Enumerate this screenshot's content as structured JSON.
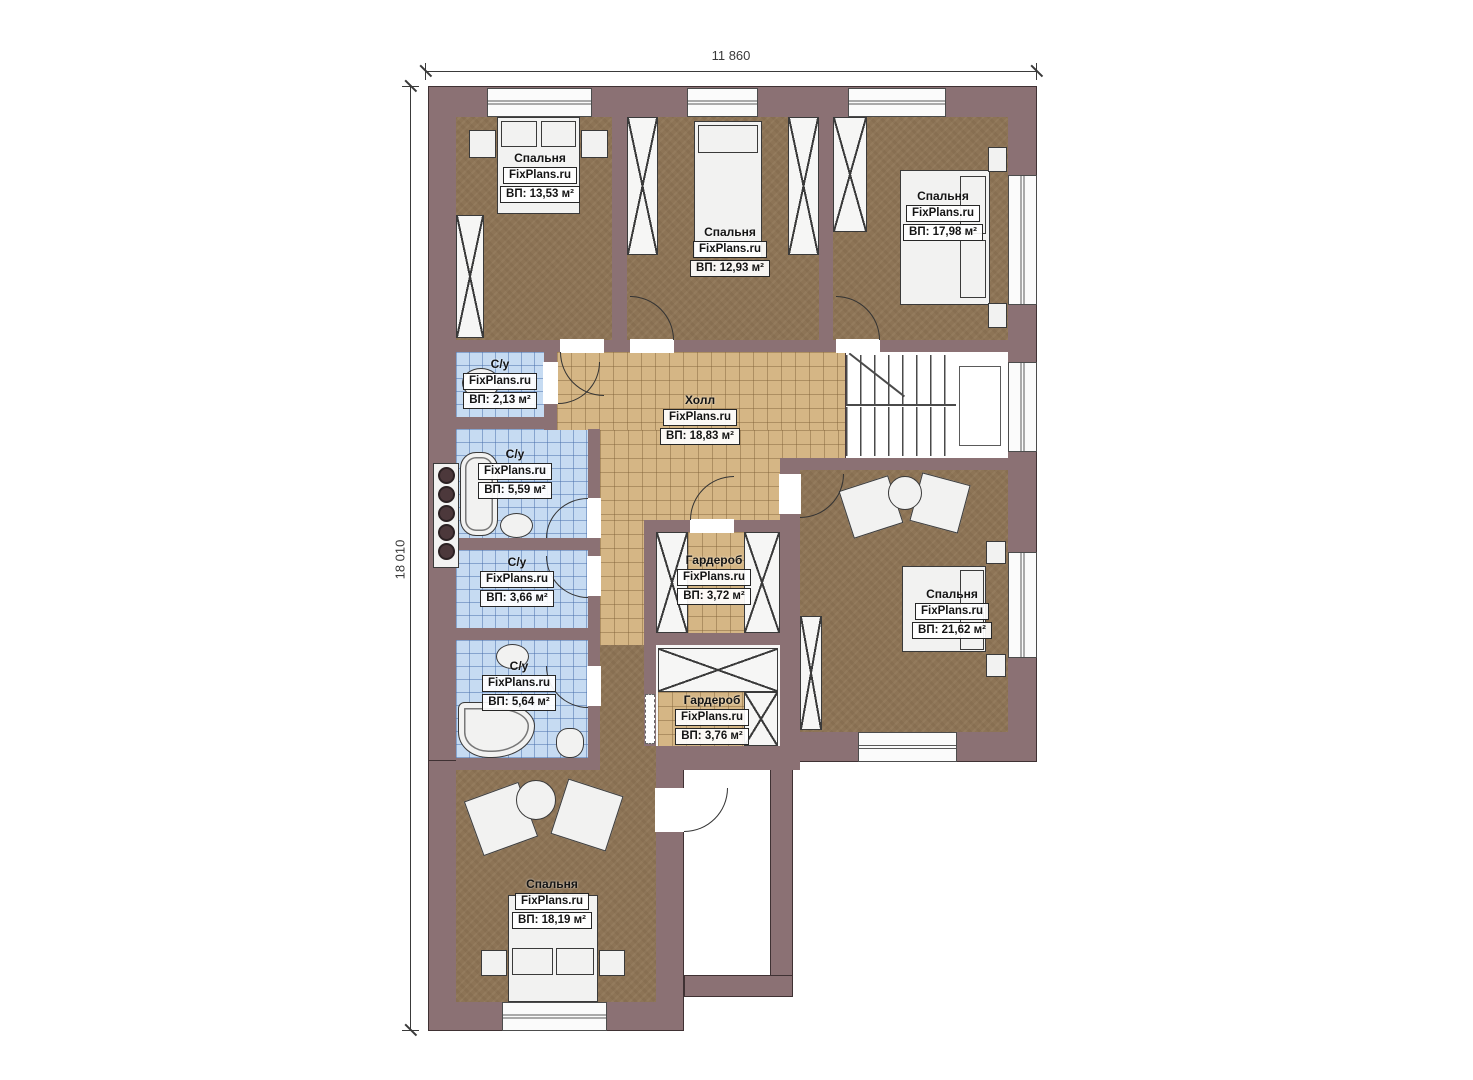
{
  "plan": {
    "dim_width": "11 860",
    "dim_height": "18 010",
    "watermark": "FixPlans.ru",
    "colors": {
      "wall": "#8b7174",
      "bedroom_floor": "#8d7456",
      "hall_tile": "#d5b685",
      "bathroom_tile": "#c6dbf2",
      "furniture": "#f2f2f1"
    },
    "rooms": [
      {
        "name": "Спальня",
        "watermark": "FixPlans.ru",
        "area": "ВП: 13,53 м²"
      },
      {
        "name": "Спальня",
        "watermark": "FixPlans.ru",
        "area": "ВП: 12,93 м²"
      },
      {
        "name": "Спальня",
        "watermark": "FixPlans.ru",
        "area": "ВП: 17,98 м²"
      },
      {
        "name": "С/у",
        "watermark": "FixPlans.ru",
        "area": "ВП: 2,13 м²"
      },
      {
        "name": "Холл",
        "watermark": "FixPlans.ru",
        "area": "ВП: 18,83 м²"
      },
      {
        "name": "С/у",
        "watermark": "FixPlans.ru",
        "area": "ВП: 5,59 м²"
      },
      {
        "name": "С/у",
        "watermark": "FixPlans.ru",
        "area": "ВП: 3,66 м²"
      },
      {
        "name": "Гардероб",
        "watermark": "FixPlans.ru",
        "area": "ВП: 3,72 м²"
      },
      {
        "name": "Спальня",
        "watermark": "FixPlans.ru",
        "area": "ВП: 21,62 м²"
      },
      {
        "name": "С/у",
        "watermark": "FixPlans.ru",
        "area": "ВП: 5,64 м²"
      },
      {
        "name": "Гардероб",
        "watermark": "FixPlans.ru",
        "area": "ВП: 3,76 м²"
      },
      {
        "name": "Спальня",
        "watermark": "FixPlans.ru",
        "area": "ВП: 18,19 м²"
      }
    ]
  }
}
